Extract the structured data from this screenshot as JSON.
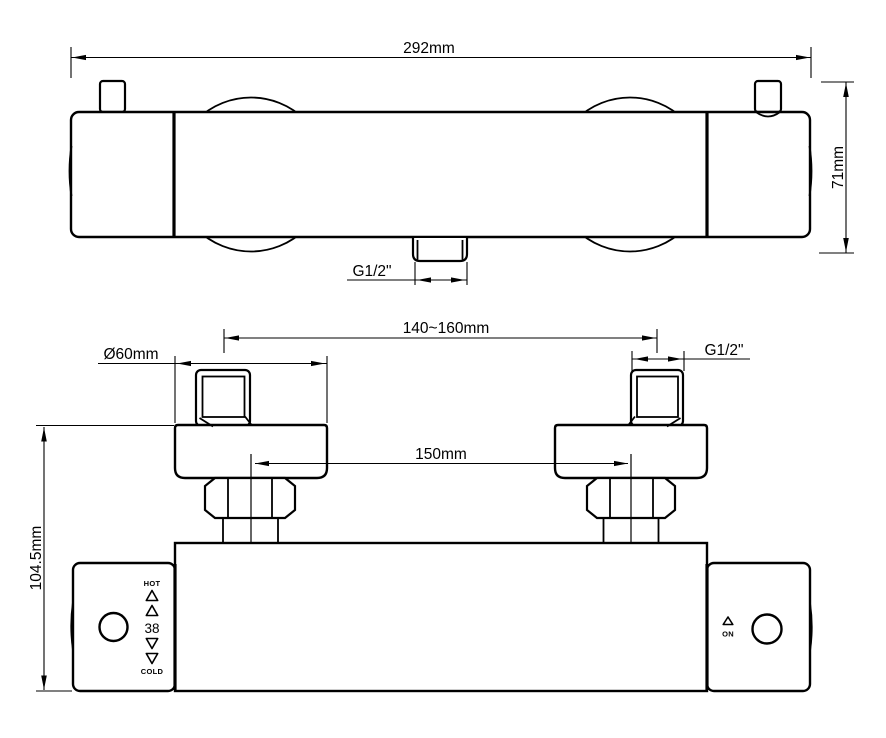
{
  "colors": {
    "line": "#000000",
    "background": "#ffffff"
  },
  "top_view": {
    "overall_width": "292mm",
    "overall_height": "71mm",
    "outlet_thread": "G1/2\""
  },
  "front_view": {
    "inlet_spacing_range": "140~160mm",
    "escutcheon_diameter": "Ø60mm",
    "inlet_thread": "G1/2\"",
    "valve_center_distance": "150mm",
    "overall_height": "104.5mm",
    "temperature_handle": {
      "hot_label": "HOT",
      "preset_temperature": "38",
      "cold_label": "COLD"
    },
    "flow_handle": {
      "on_label": "ON"
    }
  }
}
